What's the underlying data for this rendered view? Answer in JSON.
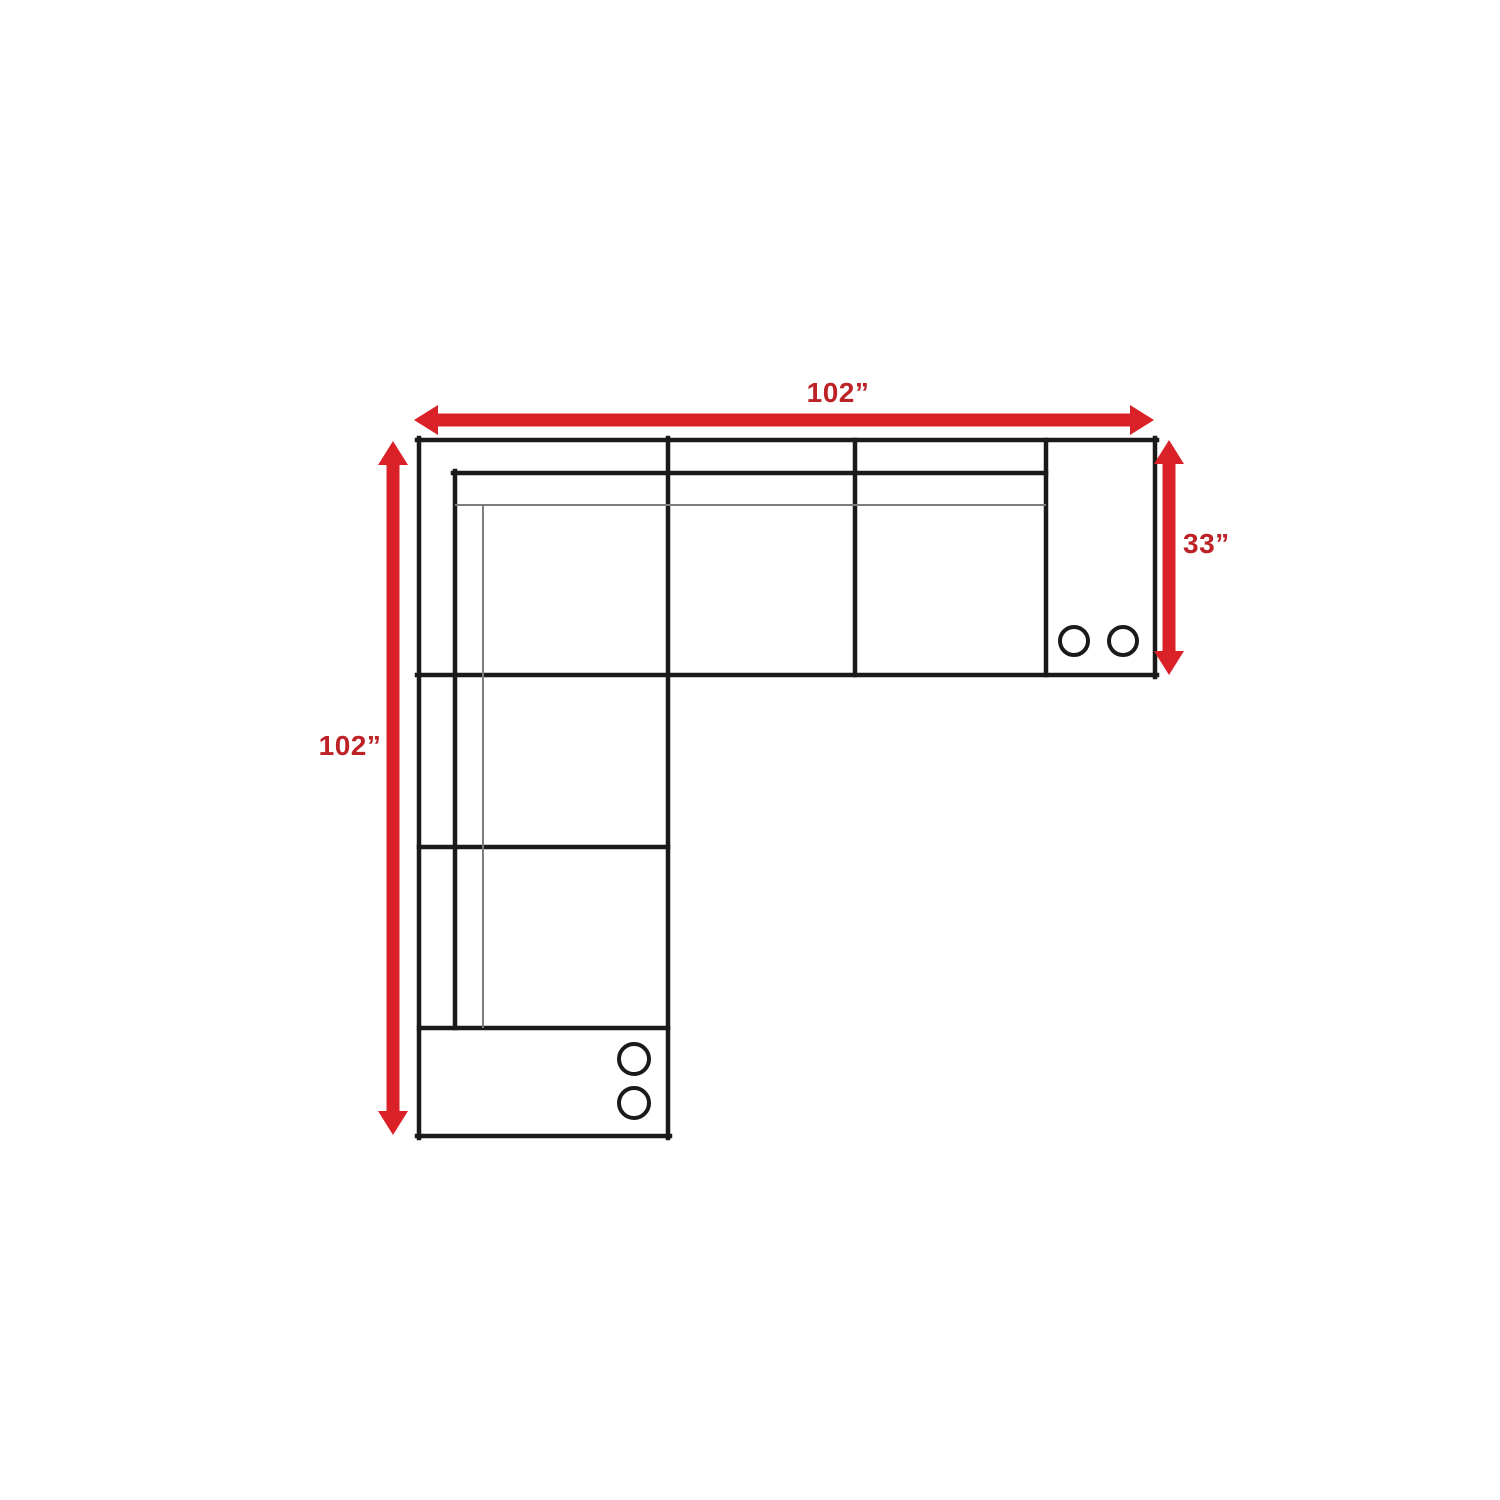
{
  "diagram": {
    "type": "furniture-dimension-diagram",
    "dimensions": {
      "top_width": {
        "text": "102”",
        "value_inches": 102
      },
      "left_height": {
        "text": "102”",
        "value_inches": 102
      },
      "right_depth": {
        "text": "33”",
        "value_inches": 33
      }
    },
    "cup_holders": {
      "right_console_count": 2,
      "bottom_console_count": 2
    },
    "colors": {
      "arrow_red": "#da2128",
      "label_red": "#bd2227",
      "outline_black": "#1a1a1a",
      "thin_gray": "#7d7d7d",
      "background": "#ffffff"
    }
  }
}
